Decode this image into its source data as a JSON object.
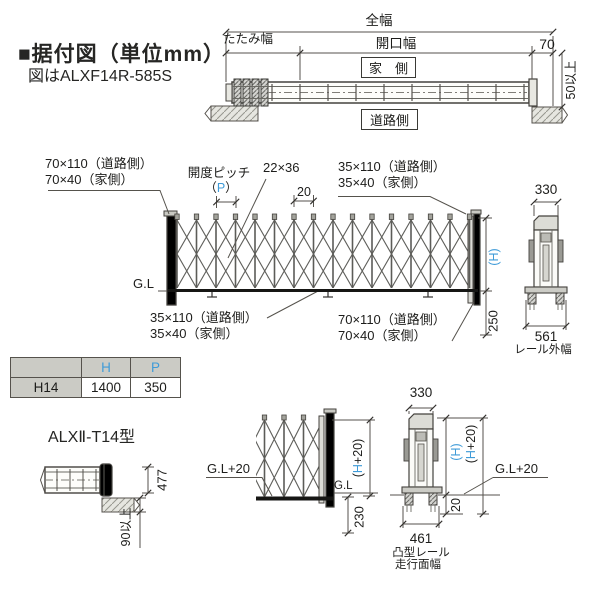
{
  "colors": {
    "accent": "#3f9bd8",
    "line": "#555550",
    "table_header_bg": "#cbcbc5"
  },
  "title": {
    "heading": "■据付図（単位mm）",
    "subheading": "図はALXF14R-585S"
  },
  "plan_view": {
    "dim_total": "全幅",
    "dim_fold": "たたみ幅",
    "dim_opening": "開口幅",
    "dim_70": "70",
    "house_side": "家　側",
    "road_side": "道路側",
    "dim_min50": "50以上"
  },
  "elevation": {
    "frame_top_label_1": "70×110（道路側）",
    "frame_top_label_2": "70×40（家側）",
    "pitch_label": "開度ピッチ",
    "pitch_p": [
      "（",
      "P",
      "）"
    ],
    "crossbar_label": "22×36",
    "dim_20": "20",
    "end_top_label_1": "35×110（道路側）",
    "end_top_label_2": "35×40（家側）",
    "dim_330": "330",
    "gl": "G.L",
    "bottom_left_label_1": "35×110（道路側）",
    "bottom_left_label_2": "35×40（家側）",
    "bottom_right_label_1": "70×110（道路側）",
    "bottom_right_label_2": "70×40（家側）",
    "dim_h": [
      "(",
      "H",
      ")"
    ],
    "dim_250": "250",
    "dim_561": "561",
    "rail_outer_width": "レール外幅"
  },
  "spec_table": {
    "headers": [
      "",
      "H",
      "P"
    ],
    "row": [
      "H14",
      "1400",
      "350"
    ]
  },
  "model_label": "ALXⅡ-T14型",
  "detail_plan": {
    "dim_477": "477",
    "dim_min90": "90以上"
  },
  "section_gate": {
    "gl20": "G.L+20",
    "gl": "G.L",
    "dim_h20": [
      "(",
      "H",
      "+20)"
    ],
    "dim_230": "230"
  },
  "section_post": {
    "dim_330": "330",
    "dim_h": [
      "(",
      "H",
      ")"
    ],
    "dim_h20": [
      "(",
      "H",
      "+20)"
    ],
    "gl20": "G.L+20",
    "dim_20": "20",
    "dim_461": "461",
    "rail_label_1": "凸型レール",
    "rail_label_2": "走行面幅"
  }
}
